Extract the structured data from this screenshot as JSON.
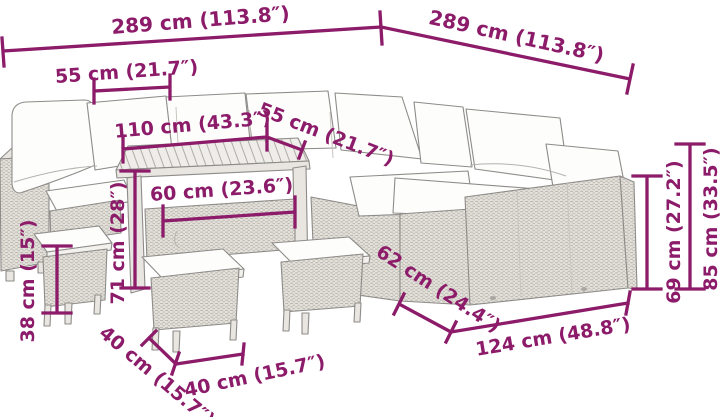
{
  "diagram": {
    "subject": "garden-lounge-set-dimension-diagram",
    "dimensions": {
      "overall_width_left": "289 cm (113.8″)",
      "overall_depth_right": "289 cm (113.8″)",
      "seat_section_width": "55 cm (21.7″)",
      "table_length": "110 cm (43.3″)",
      "seat_depth": "55 cm (21.7″)",
      "table_width": "60 cm (23.6″)",
      "table_height": "71 cm (28″)",
      "stool_height": "38 cm (15″)",
      "stool_depth": "40 cm (15.7″)",
      "stool_width": "40 cm (15.7″)",
      "sofa_depth": "62 cm (24.4″)",
      "sofa_section_width": "124 cm (48.8″)",
      "armrest_height": "69 cm (27.2″)",
      "backrest_height": "85 cm (33.5″)"
    }
  },
  "colors": {
    "dimension": "#8c1b69",
    "background": "#ffffff",
    "line_art": "#8e8c89"
  }
}
